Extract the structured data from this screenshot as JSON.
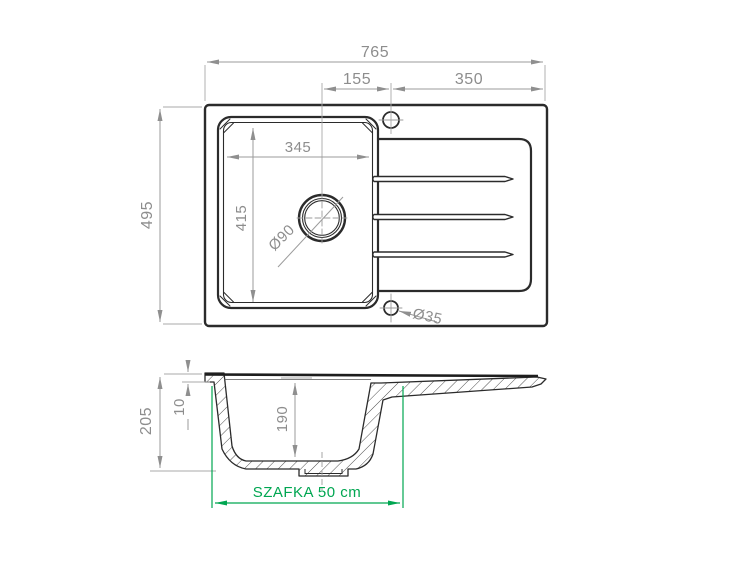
{
  "drawing": {
    "kind": "sink-technical-drawing",
    "colors": {
      "geometry_line": "#2b2b2b",
      "dimension_line": "#9b9b9b",
      "dimension_text": "#8d8d8d",
      "cabinet_accent": "#00a651",
      "background": "#ffffff"
    },
    "top_view": {
      "overall_width": "765",
      "drain_to_faucet": "155",
      "faucet_to_right_edge": "350",
      "bowl_inner_width": "345",
      "bowl_inner_length": "415",
      "overall_depth": "495",
      "drain_diameter": "Ø90",
      "hole_diameter": "Ø35"
    },
    "section_view": {
      "overall_height": "205",
      "rim_height": "10",
      "bowl_depth": "190",
      "cabinet_label": "SZAFKA 50 cm"
    }
  }
}
